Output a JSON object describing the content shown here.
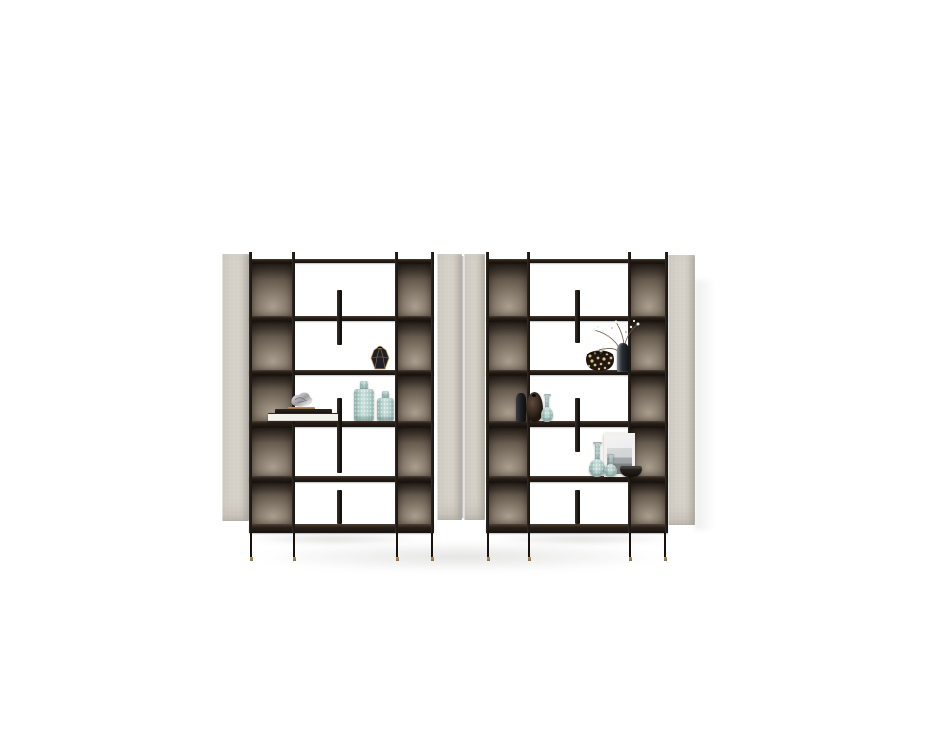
{
  "scene": {
    "type": "studio-product-photograph",
    "subject": "Two freestanding modular bookcase units with black metal frames, smoked-bronze mirror back panels, light greige upholstered side panels and decorative objects, on a plain white background",
    "background_color": "#ffffff"
  },
  "colors": {
    "background": "#ffffff",
    "beige_panel": "#d7d2c9",
    "beige_panel_edge": "#b2aca1",
    "frame_black": "#1c1814",
    "shelf_wood": "#271f19",
    "bronze_dark": "#2c251f",
    "bronze_mid": "#6d6154",
    "bronze_light": "#aa9e8f",
    "teal_glass": "#a9cac5",
    "gold_accent": "#b8935f",
    "shadow_tone": "#46403a"
  },
  "units": [
    {
      "id": "left",
      "label": "Left shelving unit",
      "frame": "black metal uprights and thin legs with brass feet",
      "side_panels": "light greige textured panels",
      "back_panels": "smoked bronze mirror in outer columns",
      "shelf_count": 6,
      "row_count": 5,
      "decor": [
        {
          "name": "faceted gem vase",
          "row": 2,
          "description": "dark faceted vase with gold edges"
        },
        {
          "name": "silver sculpture",
          "row": 3,
          "description": "crumpled metallic ornament on book stack"
        },
        {
          "name": "book stack",
          "row": 3,
          "description": "two white books, one dark book and a gold dish"
        },
        {
          "name": "teal glass vase tall",
          "row": 3,
          "description": "textured aqua glass vase"
        },
        {
          "name": "teal glass vase short",
          "row": 3,
          "description": "textured aqua glass vase"
        }
      ]
    },
    {
      "id": "right",
      "label": "Right shelving unit",
      "frame": "black metal uprights and thin legs with brass feet",
      "side_panels": "light greige textured panels",
      "back_panels": "smoked bronze mirror in outer columns",
      "shelf_count": 6,
      "row_count": 5,
      "decor": [
        {
          "name": "leopard print bowl",
          "row": 2,
          "description": "dark bowl with cream spots"
        },
        {
          "name": "vase with dried branches",
          "row": 2,
          "description": "dark glass vase with white blossom twigs"
        },
        {
          "name": "black vase",
          "row": 3,
          "description": "slim charcoal vase"
        },
        {
          "name": "brown round vase",
          "row": 3,
          "description": "egg-shaped dark brown vase"
        },
        {
          "name": "teal bottle small",
          "row": 3,
          "description": "aqua genie bottle"
        },
        {
          "name": "teal bottle tall",
          "row": 4,
          "description": "aqua genie bottle"
        },
        {
          "name": "teal bottle short",
          "row": 4,
          "description": "aqua genie bottle"
        },
        {
          "name": "framed picture",
          "row": 4,
          "description": "white framed grayscale landscape leaning on shelf"
        },
        {
          "name": "dark bowl",
          "row": 4,
          "description": "small black bowl"
        }
      ]
    }
  ]
}
